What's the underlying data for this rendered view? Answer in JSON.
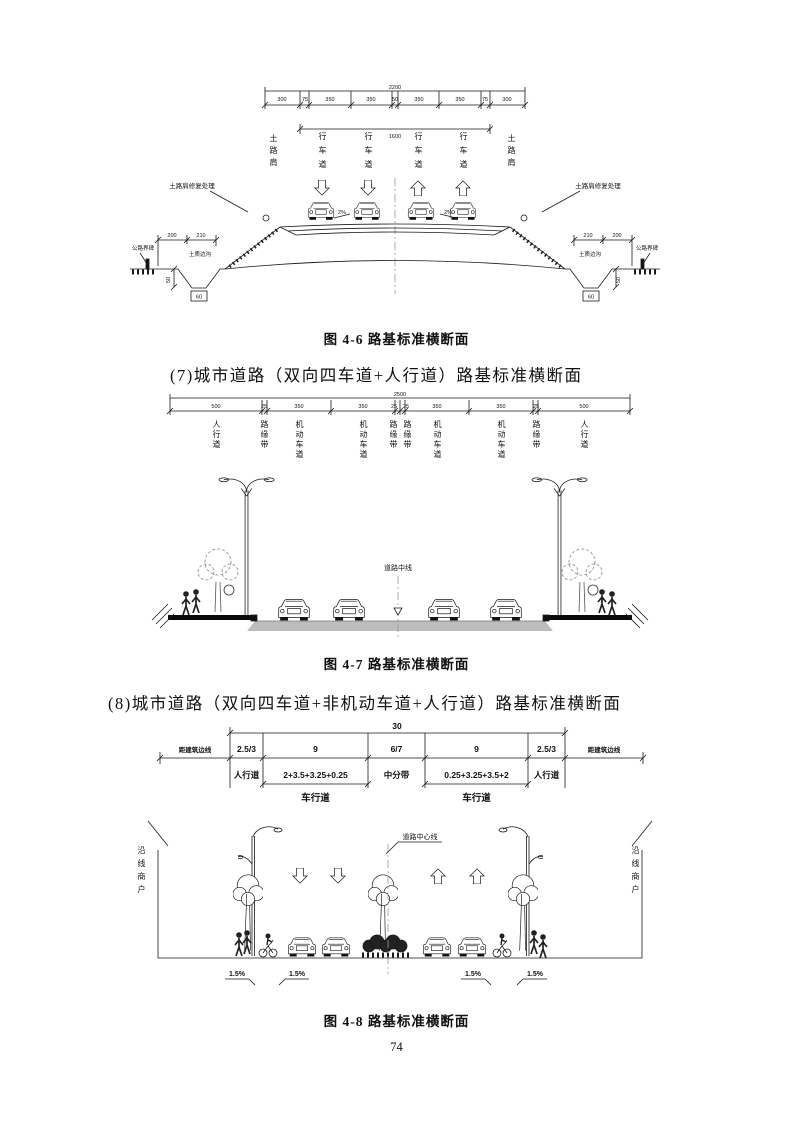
{
  "page_number": "74",
  "headings": {
    "h7": "(7)城市道路（双向四车道+人行道）路基标准横断面",
    "h8": "(8)城市道路（双向四车道+非机动车道+人行道）路基标准横断面"
  },
  "fig46": {
    "caption": "图 4-6  路基标准横断面",
    "dim_total": "2200",
    "dims": [
      "300",
      "75",
      "350",
      "350",
      "50",
      "350",
      "350",
      "75",
      "300"
    ],
    "dim_inner": "1600",
    "shoulder": "土路肩",
    "lane": "行车道",
    "slope_note": "土路肩修复处理",
    "boundary_note": "公路界碑",
    "ditch_note": "土质边沟",
    "ditch_dims_left": [
      "200",
      "210"
    ],
    "ditch_dims_right": [
      "210",
      "200"
    ],
    "ditch_depth": "50",
    "ditch_width": "60",
    "cross_slope": "2%"
  },
  "fig47": {
    "caption": "图 4-7  路基标准横断面",
    "dim_total": "2500",
    "dims": [
      "500",
      "25",
      "350",
      "350",
      "25",
      "25",
      "350",
      "350",
      "25",
      "500"
    ],
    "labels": [
      "人行道",
      "路缘带",
      "机动车道",
      "机动车道",
      "路缘带",
      "路缘带",
      "机动车道",
      "机动车道",
      "路缘带",
      "人行道"
    ],
    "centerline": "道路中线"
  },
  "fig48": {
    "caption": "图 4-8  路基标准横断面",
    "dim_total": "30",
    "row_dims": [
      "2.5/3",
      "9",
      "6/7",
      "9",
      "2.5/3"
    ],
    "row_labels": [
      "人行道",
      "2+3.5+3.25+0.25",
      "中分带",
      "0.25+3.25+3.5+2",
      "人行道"
    ],
    "carriageway": "车行道",
    "building_line": "距建筑边线",
    "shops": "沿线商户",
    "centerline": "道路中心线",
    "slope": "1.5%"
  }
}
